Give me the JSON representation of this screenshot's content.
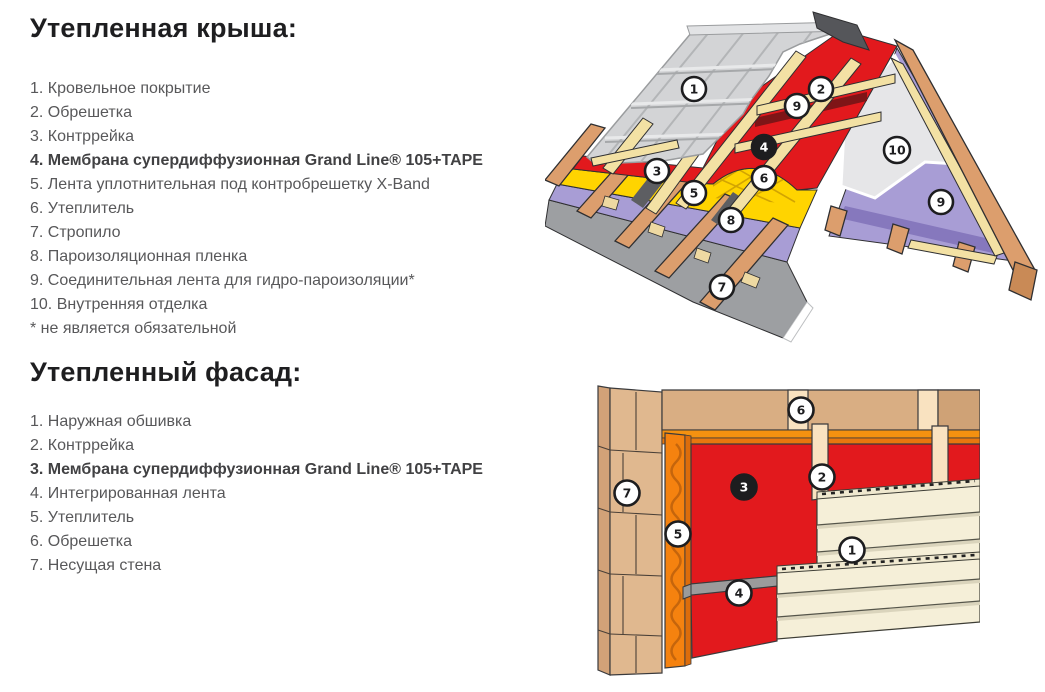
{
  "roof_section": {
    "heading": "Утепленная крыша:",
    "items": [
      "1. Кровельное покрытие",
      "2. Обрешетка",
      "3. Контррейка",
      "4. Мембрана супердиффузионная Grand Line® 105+TAPE",
      "5. Лента уплотнительная под контробрешетку X-Band",
      "6. Утеплитель",
      "7. Стропило",
      "8. Пароизоляционная пленка",
      "9. Соединительная лента для гидро-пароизоляции*",
      "10. Внутренняя отделка",
      "* не является обязательной"
    ]
  },
  "facade_section": {
    "heading": "Утепленный фасад:",
    "items": [
      "1. Наружная обшивка",
      "2. Контррейка",
      "3. Мембрана супердиффузионная Grand Line® 105+TAPE",
      "4. Интегрированная лента",
      "5. Утеплитель",
      "6. Обрешетка",
      "7. Несущая стена"
    ]
  },
  "roof_diagram": {
    "description": "cutaway of insulated pitched roof",
    "markers": [
      {
        "label": "1",
        "dark": false
      },
      {
        "label": "2",
        "dark": false
      },
      {
        "label": "9",
        "dark": false
      },
      {
        "label": "4",
        "dark": true
      },
      {
        "label": "3",
        "dark": false
      },
      {
        "label": "5",
        "dark": false
      },
      {
        "label": "6",
        "dark": false
      },
      {
        "label": "8",
        "dark": false
      },
      {
        "label": "7",
        "dark": false
      },
      {
        "label": "10",
        "dark": false
      },
      {
        "label": "9",
        "dark": false
      }
    ]
  },
  "facade_diagram": {
    "description": "cutaway of insulated facade wall",
    "markers": [
      {
        "label": "6",
        "dark": false
      },
      {
        "label": "2",
        "dark": false
      },
      {
        "label": "7",
        "dark": false
      },
      {
        "label": "3",
        "dark": true
      },
      {
        "label": "5",
        "dark": false
      },
      {
        "label": "1",
        "dark": false
      },
      {
        "label": "4",
        "dark": false
      }
    ]
  },
  "palette": {
    "heading_text": "#1e1e20",
    "list_text": "#58585a",
    "membrane_red": "#e2191d",
    "insulation_yellow": "#ffd400",
    "insulation_orange": "#f5820f",
    "vapor_purple": "#a89dd5",
    "vapor_purple_dark": "#8678bd",
    "tile_grey": "#d3d4d6",
    "sheet_grey": "#9d9fa2",
    "wood_brown": "#dc9e6d",
    "batten_cream": "#f3e1a4",
    "siding_cream": "#f5efd8",
    "brick_tan": "#e0b88f",
    "lining_white": "#e6e6e8",
    "tape_grey": "#9b9b9b"
  }
}
